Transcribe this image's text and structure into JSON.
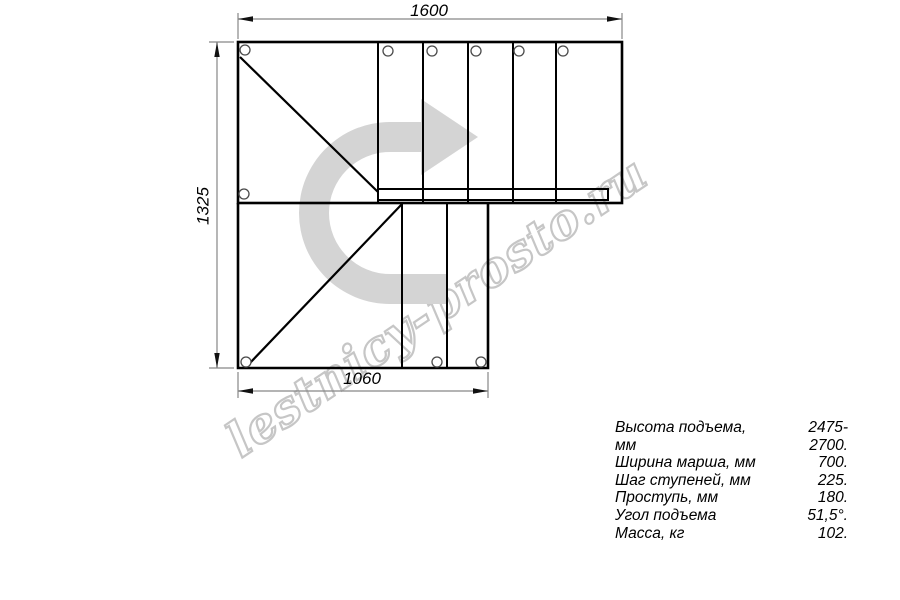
{
  "watermark": {
    "text": "lestnicy-prosto.ru"
  },
  "drawing": {
    "type": "staircase-plan-top-view-90-degree-turn",
    "dimensions": {
      "top_width_mm": "1600",
      "left_height_mm": "1325",
      "bottom_width_mm": "1060"
    },
    "direction_arrow": "curved-arrow-turn-right",
    "colors": {
      "line": "#000000",
      "dimension_line": "#878787",
      "arrow_fill": "#d4d4d4",
      "watermark_outline": "#c6c6c6"
    }
  },
  "specs": {
    "rows": [
      {
        "label": "Высота подъема, мм",
        "value": "2475-2700."
      },
      {
        "label": "Ширина марша, мм",
        "value": "700."
      },
      {
        "label": "Шаг ступеней, мм",
        "value": "225."
      },
      {
        "label": "Проступь, мм",
        "value": "180."
      },
      {
        "label": "Угол подъема",
        "value": "51,5°."
      },
      {
        "label": "Масса, кг",
        "value": "102."
      }
    ]
  }
}
